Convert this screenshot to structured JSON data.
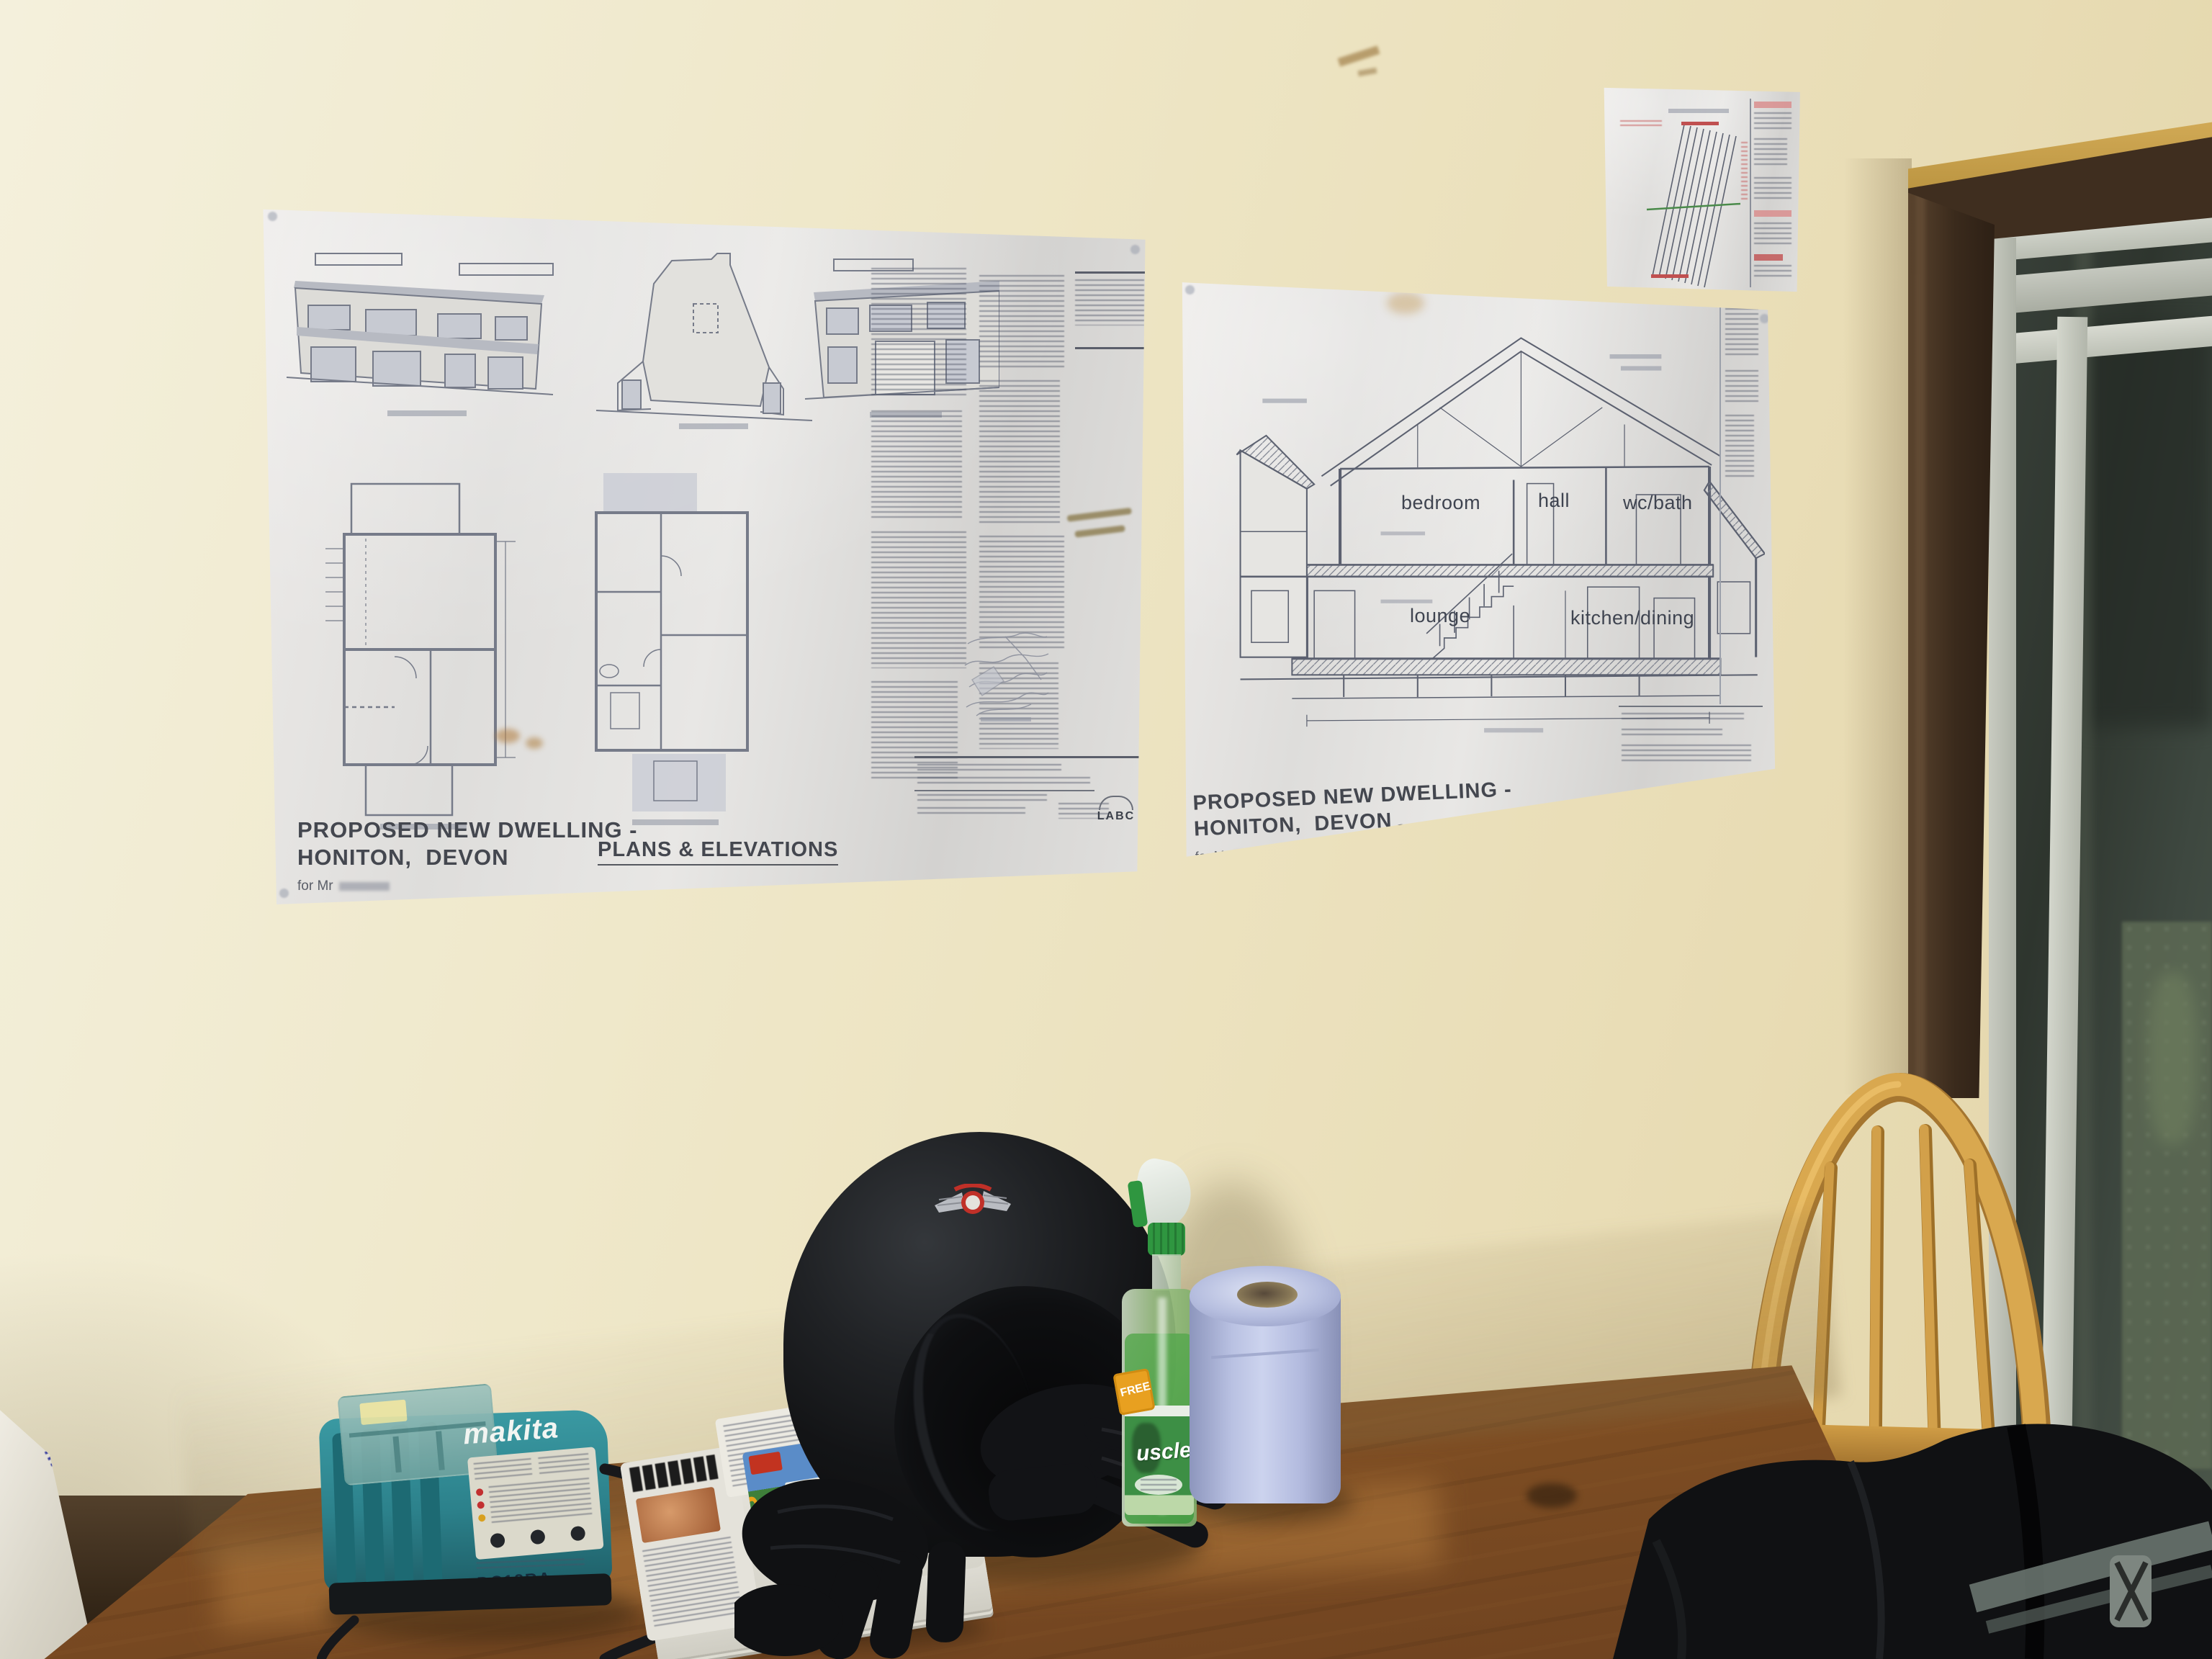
{
  "sheets": {
    "left": {
      "title_line1": "PROPOSED NEW DWELLING -",
      "title_line2": "HONITON,  DEVON",
      "client_line": "for Mr",
      "drawing_title": "PLANS & ELEVATIONS",
      "stamp": "LABC"
    },
    "right": {
      "title_line1": "PROPOSED NEW DWELLING -",
      "title_line2": "HONITON,  DEVON",
      "client_line": "for Mr",
      "drawing_title": "SECTION A-A",
      "room_labels": {
        "bedroom": "bedroom",
        "hall": "hall",
        "wc_bath": "wc/bath",
        "lounge": "lounge",
        "kitchen_dining": "kitchen/dining"
      }
    }
  },
  "objects": {
    "charger": {
      "brand": "makita",
      "model": "DC18RA"
    },
    "spray_bottle": {
      "brand_visible": "uscle",
      "flash_text": "FREE"
    },
    "newspaper": {
      "advert_text": "SAVE"
    },
    "carrier_bag": {
      "printed_text": "wson.co.uk"
    }
  },
  "colors": {
    "wall": "#ece3c2",
    "table_wood": "#8a5a30",
    "chair_wood": "#d2a04a",
    "charger_teal": "#2f8e96",
    "paper_roll_blue": "#aab3d8",
    "cleaner_green": "#3f9b3f",
    "door_frame_brown": "#3f2e1f"
  }
}
